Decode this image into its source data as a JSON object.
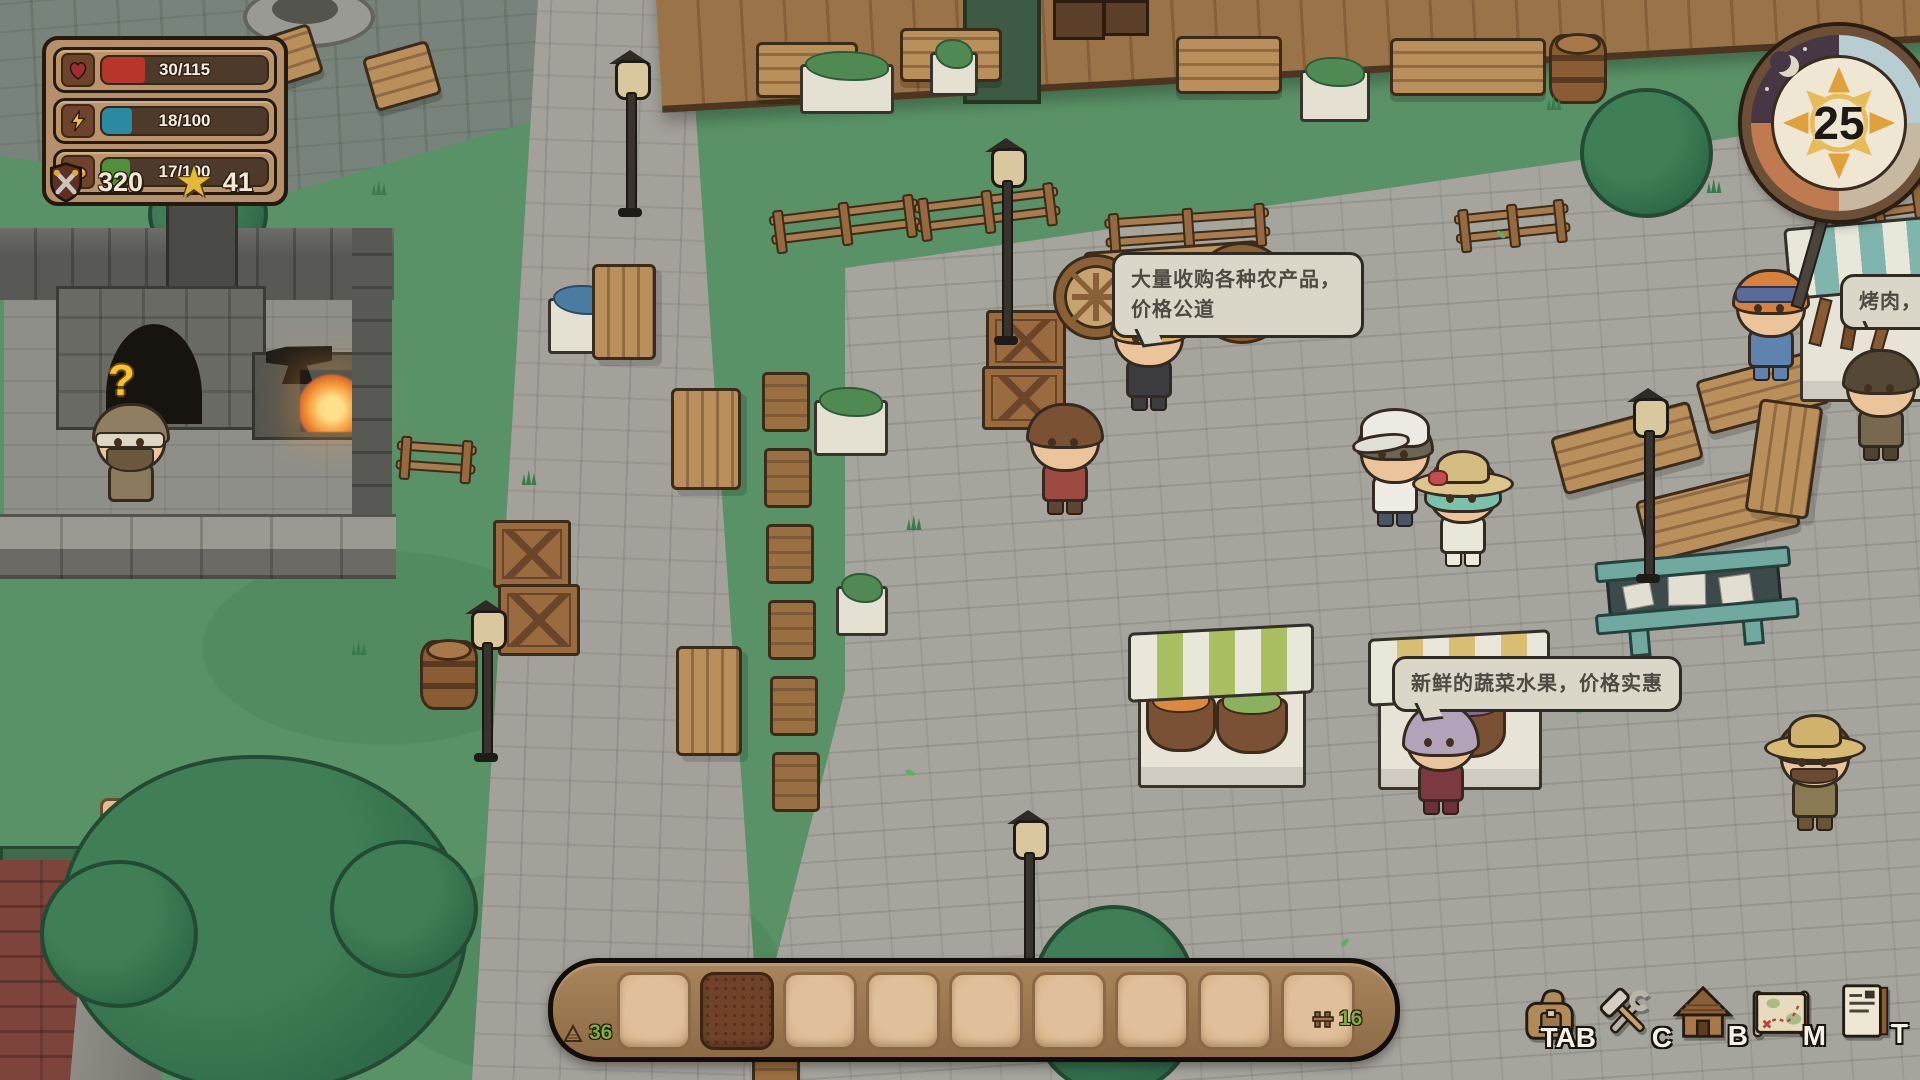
{
  "hud": {
    "stats": [
      {
        "label": "health",
        "icon": "heart-icon",
        "value": "30/115",
        "color": "#b8352b",
        "fill_pct": 26
      },
      {
        "label": "energy",
        "icon": "lightning-icon",
        "value": "18/100",
        "color": "#2a8aa3",
        "fill_pct": 18
      },
      {
        "label": "satiety",
        "icon": "bread-icon",
        "value": "17/100",
        "color": "#4f9138",
        "fill_pct": 17
      }
    ],
    "counters": [
      {
        "icon": "combat-shield-icon",
        "value": "320"
      },
      {
        "icon": "star-icon",
        "value": "41",
        "star_glyph": "★"
      }
    ]
  },
  "clock": {
    "day": "25"
  },
  "world": {
    "quest_marker": "?"
  },
  "bubbles": [
    {
      "speaker": "produce-buyer",
      "text": "大量收购各种农产品，价格公道"
    },
    {
      "speaker": "vegetable-vendor",
      "text": "新鲜的蔬菜水果，价格实惠"
    },
    {
      "speaker": "bbq-vendor",
      "text": "烤肉，烤蔬"
    }
  ],
  "hotbar": {
    "slot_count": 9,
    "selected_index": 1,
    "left_counter": {
      "icon": "wood-icon",
      "value": "36"
    },
    "right_counter": {
      "icon": "fence-icon",
      "value": "16"
    },
    "count_color": "#7fae3e"
  },
  "shortcuts": {
    "items": [
      {
        "key": "TAB",
        "icon": "backpack-icon"
      },
      {
        "key": "C",
        "icon": "craft-tools-icon"
      },
      {
        "key": "B",
        "icon": "house-icon"
      },
      {
        "key": "M",
        "icon": "map-icon"
      },
      {
        "key": "T",
        "icon": "note-icon"
      }
    ]
  }
}
